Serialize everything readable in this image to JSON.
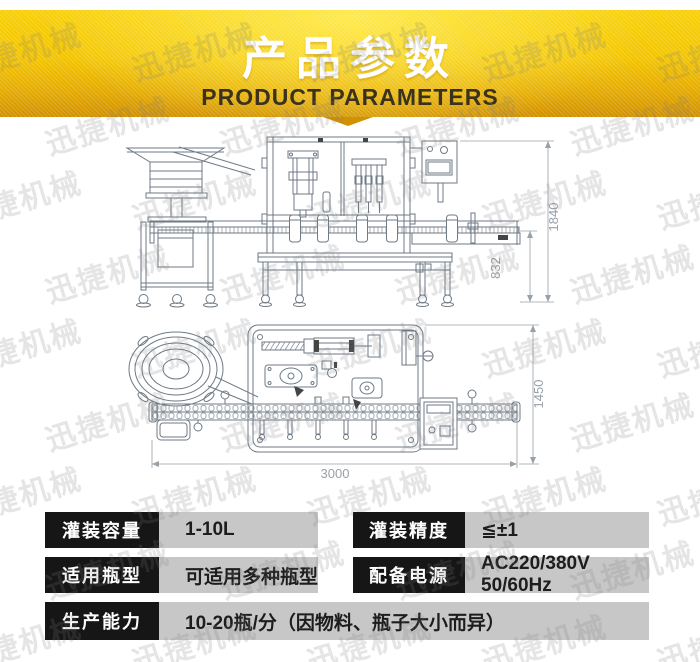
{
  "header": {
    "title": "产品参数",
    "subtitle": "PRODUCT PARAMETERS"
  },
  "watermark": {
    "text": "迅捷机械"
  },
  "drawings": {
    "front_view": {
      "dim_total_height": "1840",
      "dim_conveyor_height": "832"
    },
    "top_view": {
      "dim_total_length": "3000",
      "dim_total_width": "1450"
    }
  },
  "specs": {
    "rows": [
      {
        "label": "灌装容量",
        "value": "1-10L"
      },
      {
        "label": "灌装精度",
        "value": "≦±1"
      },
      {
        "label": "适用瓶型",
        "value": "可适用多种瓶型"
      },
      {
        "label": "配备电源",
        "value": "AC220/380V 50/60Hz"
      },
      {
        "label": "生产能力",
        "value": "10-20瓶/分（因物料、瓶子大小而异）"
      }
    ]
  },
  "colors": {
    "banner_gold": "#f3c503",
    "label_bg": "#161616",
    "value_bg": "#c7c7c7",
    "drawing_line": "#6e7a84",
    "dim_line": "#98a0a8"
  }
}
